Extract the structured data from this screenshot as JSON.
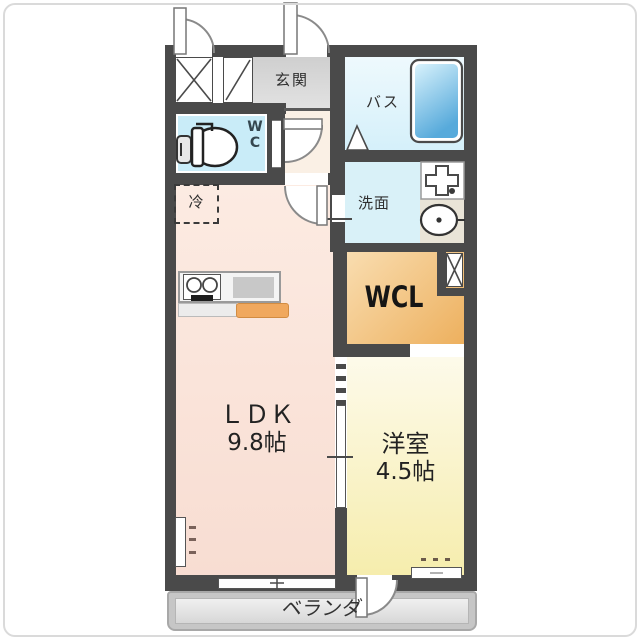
{
  "plan": {
    "title": "1LDK floor plan",
    "rooms": {
      "genkan": {
        "label": "玄関"
      },
      "bath": {
        "label": "バス"
      },
      "wc": {
        "lines": [
          "W",
          "C"
        ]
      },
      "senmen": {
        "label": "洗面"
      },
      "fridge": {
        "label": "冷"
      },
      "wcl": {
        "label": "WCL"
      },
      "ldk": {
        "label": "ＬＤＫ",
        "size": "9.8帖"
      },
      "yoshitsu": {
        "label": "洋室",
        "size": "4.5帖"
      },
      "veranda": {
        "label": "ベランダ"
      }
    },
    "colors": {
      "wall": "#4a4a4a",
      "ldk_floor": "#fbe7dd",
      "wcl_floor": "#f2c080",
      "yoshitsu_floor": "#f9f2c6",
      "bath_floor": "#e6f7fc",
      "wc_floor": "#c9ecf8",
      "senmen_floor": "#d9f1f8",
      "genkan_floor": "#d4d4d4",
      "hall_floor": "#faf0e5",
      "veranda_floor": "#d9d9d9",
      "bathtub": "#5aabdc",
      "kitchen_counter_accent": "#f0a85e"
    }
  }
}
